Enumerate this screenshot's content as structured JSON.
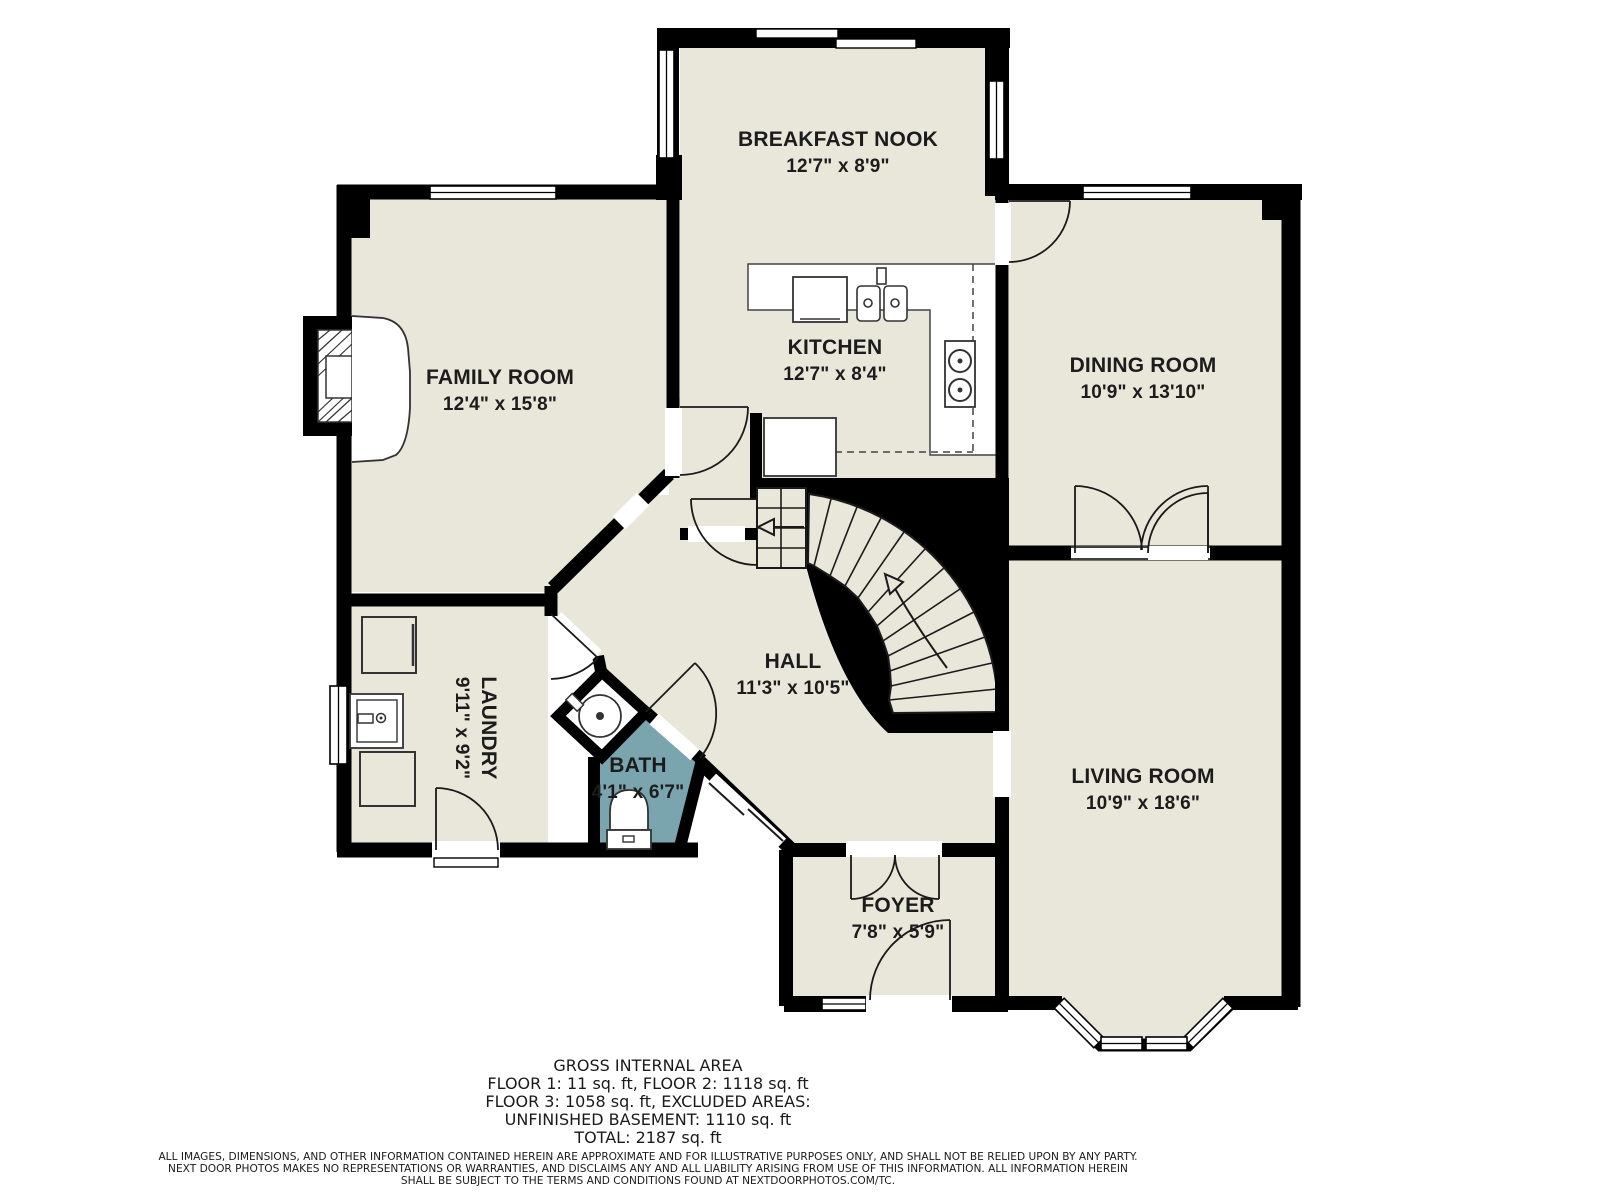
{
  "floorplan": {
    "rooms": [
      {
        "name": "BREAKFAST NOOK",
        "dims": "12'7\" x 8'9\""
      },
      {
        "name": "KITCHEN",
        "dims": "12'7\" x 8'4\""
      },
      {
        "name": "FAMILY ROOM",
        "dims": "12'4\" x 15'8\""
      },
      {
        "name": "DINING ROOM",
        "dims": "10'9\" x 13'10\""
      },
      {
        "name": "HALL",
        "dims": "11'3\" x 10'5\""
      },
      {
        "name": "LAUNDRY",
        "dims": "9'11\" x 9'2\""
      },
      {
        "name": "BATH",
        "dims": "4'1\" x 6'7\""
      },
      {
        "name": "LIVING ROOM",
        "dims": "10'9\" x 18'6\""
      },
      {
        "name": "FOYER",
        "dims": "7'8\" x 5'9\""
      }
    ],
    "colors": {
      "room_fill": "#e9e7da",
      "bath_fill": "#7aa5ae",
      "wall": "#000000",
      "background": "#ffffff"
    }
  },
  "footer": {
    "title": "GROSS INTERNAL AREA",
    "line1": "FLOOR 1: 11 sq. ft, FLOOR 2: 1118 sq. ft",
    "line2": "FLOOR 3: 1058 sq. ft, EXCLUDED AREAS:",
    "line3": "UNFINISHED BASEMENT: 1110 sq. ft",
    "line4": "TOTAL: 2187 sq. ft",
    "disclaimer1": "ALL IMAGES, DIMENSIONS, AND OTHER INFORMATION CONTAINED HEREIN ARE APPROXIMATE AND FOR ILLUSTRATIVE PURPOSES ONLY, AND SHALL NOT BE RELIED UPON BY ANY PARTY.",
    "disclaimer2": "NEXT DOOR PHOTOS MAKES NO REPRESENTATIONS OR WARRANTIES, AND DISCLAIMS ANY AND ALL LIABILITY ARISING FROM USE OF THIS INFORMATION. ALL INFORMATION HEREIN",
    "disclaimer3": "SHALL BE SUBJECT TO THE TERMS AND CONDITIONS FOUND AT NEXTDOORPHOTOS.COM/TC."
  }
}
